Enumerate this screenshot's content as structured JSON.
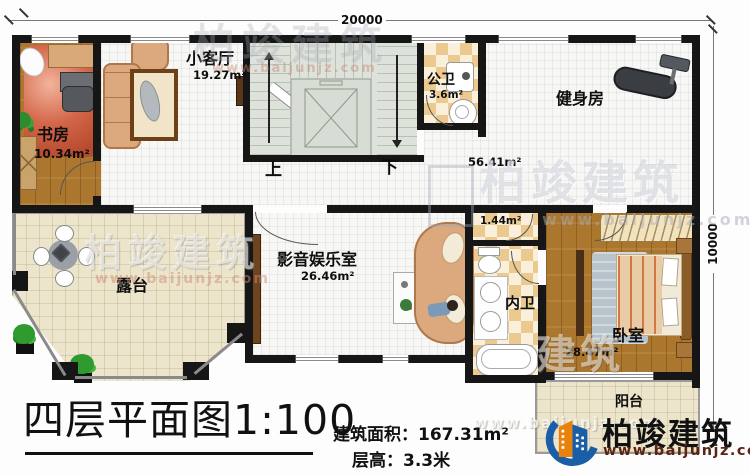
{
  "dimensions": {
    "top": "20000",
    "right": "10000"
  },
  "rooms": {
    "study": {
      "name": "书房",
      "area": "10.34m²"
    },
    "living": {
      "name": "小客厅",
      "area": "19.27m²"
    },
    "public_wc": {
      "name": "公卫",
      "area": "3.6m²"
    },
    "gym": {
      "name": "健身房",
      "area": "56.41m²"
    },
    "terrace": {
      "name": "露台",
      "area": ""
    },
    "media": {
      "name": "影音娱乐室",
      "area": "26.46m²"
    },
    "closet": {
      "name": "",
      "area": "1.44m²"
    },
    "inner_wc": {
      "name": "内卫",
      "area": ""
    },
    "bedroom": {
      "name": "卧室",
      "area": "28.47m²"
    },
    "balcony": {
      "name": "阳台",
      "area": ""
    }
  },
  "stairs": {
    "up": "上",
    "down": "下"
  },
  "titleblock": {
    "title": "四层平面图1:100",
    "area_label": "建筑面积：",
    "area_value": "167.31m²",
    "floor_height_label": "层高：",
    "floor_height_value": "3.3米"
  },
  "brand": {
    "name": "柏竣建筑",
    "website": "www.baijunjz.com"
  },
  "watermark": {
    "name": "柏竣建筑",
    "name_partial": "建筑",
    "website": "www.baijunjz.com"
  },
  "colors": {
    "wall": "#161616",
    "wood": "#ab762e",
    "checker": "#ecc98f",
    "stair": "#dde2da",
    "terrace_floor": "#ece5cb",
    "brand_blue": "#1b5ea8",
    "brand_orange": "#e8820c",
    "brand_url_text": "#5a2410"
  }
}
